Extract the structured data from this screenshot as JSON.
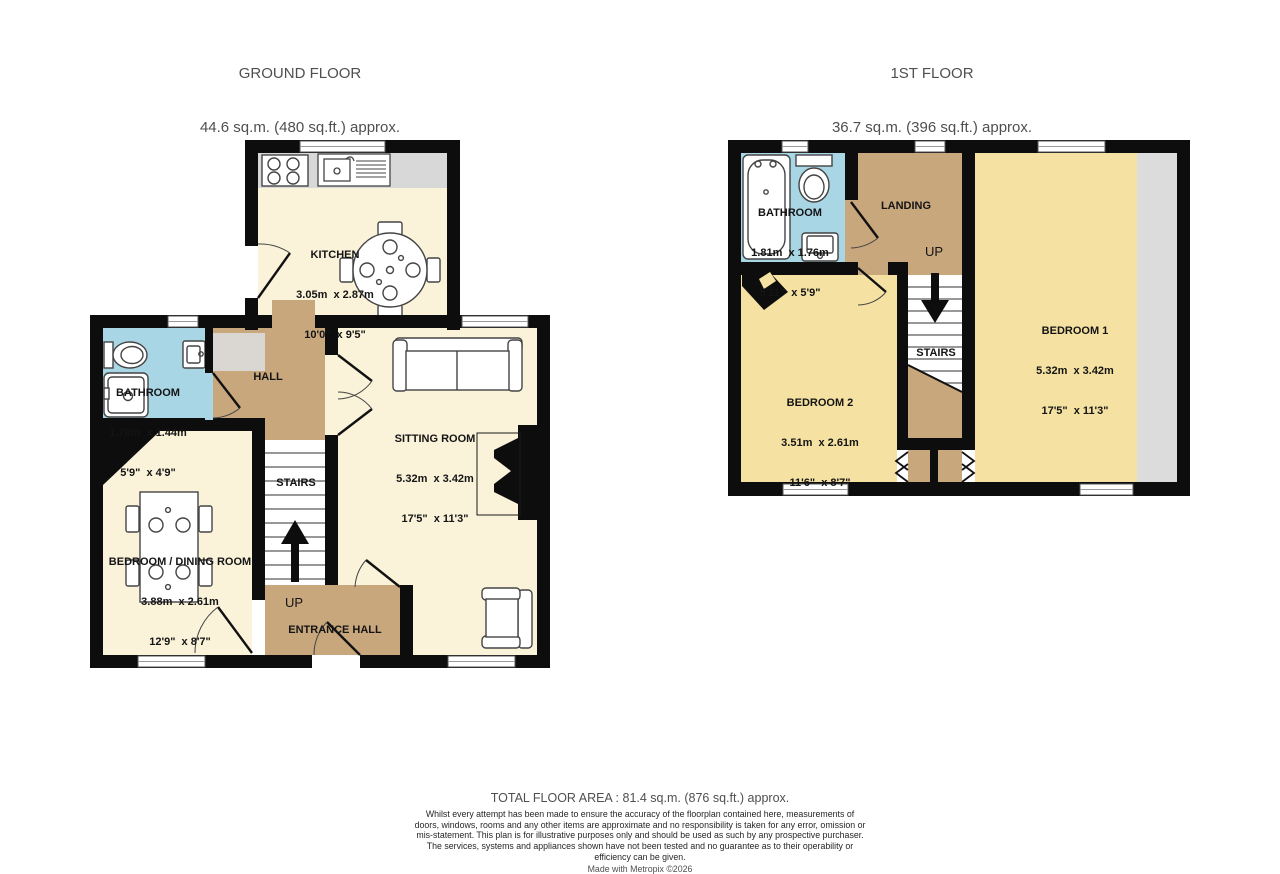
{
  "ground_floor": {
    "title": "GROUND FLOOR",
    "subtitle": "44.6 sq.m. (480 sq.ft.) approx.",
    "rooms": {
      "kitchen": {
        "label": "KITCHEN",
        "metric": "3.05m  x 2.87m",
        "imperial": "10'0\"  x 9'5\""
      },
      "bathroom": {
        "label": "BATHROOM",
        "metric": "1.76m  x 1.44m",
        "imperial": "5'9\"  x 4'9\""
      },
      "hall": {
        "label": "HALL"
      },
      "sitting_room": {
        "label": "SITTING ROOM",
        "metric": "5.32m  x 3.42m",
        "imperial": "17'5\"  x 11'3\""
      },
      "bedroom_dining": {
        "label": "BEDROOM / DINING ROOM",
        "metric": "3.88m  x 2.61m",
        "imperial": "12'9\"  x 8'7\""
      },
      "stairs": {
        "label": "STAIRS"
      },
      "up": {
        "label": "UP"
      },
      "entrance_hall": {
        "label": "ENTRANCE HALL"
      }
    }
  },
  "first_floor": {
    "title": "1ST FLOOR",
    "subtitle": "36.7 sq.m. (396 sq.ft.) approx.",
    "rooms": {
      "bathroom": {
        "label": "BATHROOM",
        "metric": "1.81m  x 1.76m",
        "imperial": "5'11\"  x 5'9\""
      },
      "landing": {
        "label": "LANDING"
      },
      "up": {
        "label": "UP"
      },
      "stairs": {
        "label": "STAIRS"
      },
      "bedroom1": {
        "label": "BEDROOM 1",
        "metric": "5.32m  x 3.42m",
        "imperial": "17'5\"  x 11'3\""
      },
      "bedroom2": {
        "label": "BEDROOM 2",
        "metric": "3.51m  x 2.61m",
        "imperial": "11'6\"  x 8'7\""
      }
    }
  },
  "footer": {
    "total": "TOTAL FLOOR AREA : 81.4 sq.m. (876 sq.ft.) approx.",
    "disclaimer": "Whilst every attempt has been made to ensure the accuracy of the floorplan contained here, measurements of doors, windows, rooms and any other items are approximate and no responsibility is taken for any error, omission or mis-statement. This plan is for illustrative purposes only and should be used as such by any prospective purchaser. The services, systems and appliances shown have not been tested and no guarantee as to their operability or efficiency can be given.",
    "credit": "Made with Metropix ©2026"
  },
  "colors": {
    "wall": "#0d0d0d",
    "room_cream": "#FAF3DA",
    "room_yellow": "#F5E2A2",
    "hall_tan": "#C9A77D",
    "bathroom_blue": "#A9D6E5",
    "fixture_gray": "#DADADA",
    "title_text": "#4f4f4f",
    "label_text": "#141414"
  }
}
